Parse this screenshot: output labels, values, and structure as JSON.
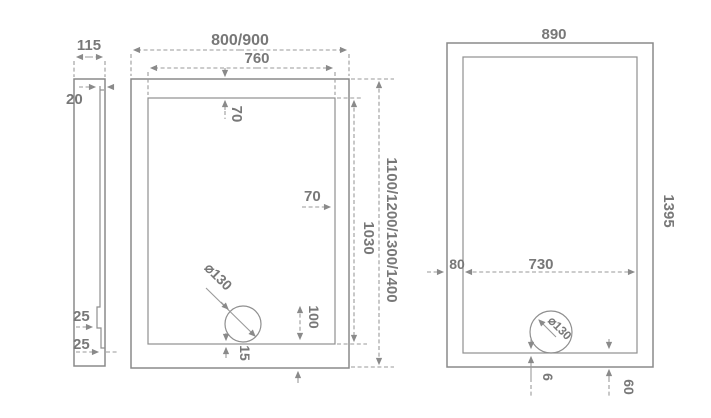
{
  "drawing": {
    "side_view": {
      "width": "115",
      "top_rim": "20",
      "step_upper": "25",
      "step_lower": "25"
    },
    "front_view": {
      "overall_width": "800/900",
      "inner_width": "760",
      "rim_top": "70",
      "rim_side": "70",
      "overall_height": "1100/1200/1300/1400",
      "inner_height": "1030",
      "drain_diameter": "⌀130",
      "drain_height": "100",
      "drain_gap": "15"
    },
    "bottom_view": {
      "overall_width": "890",
      "overall_height": "1395",
      "rim_side": "80",
      "inner_width": "730",
      "drain_diameter": "⌀130",
      "drain_gap": "6",
      "drain_offset": "60"
    }
  },
  "colors": {
    "line": "#8a8a8a",
    "dimension": "#9a9a9a",
    "text": "#787878",
    "background": "#ffffff"
  }
}
